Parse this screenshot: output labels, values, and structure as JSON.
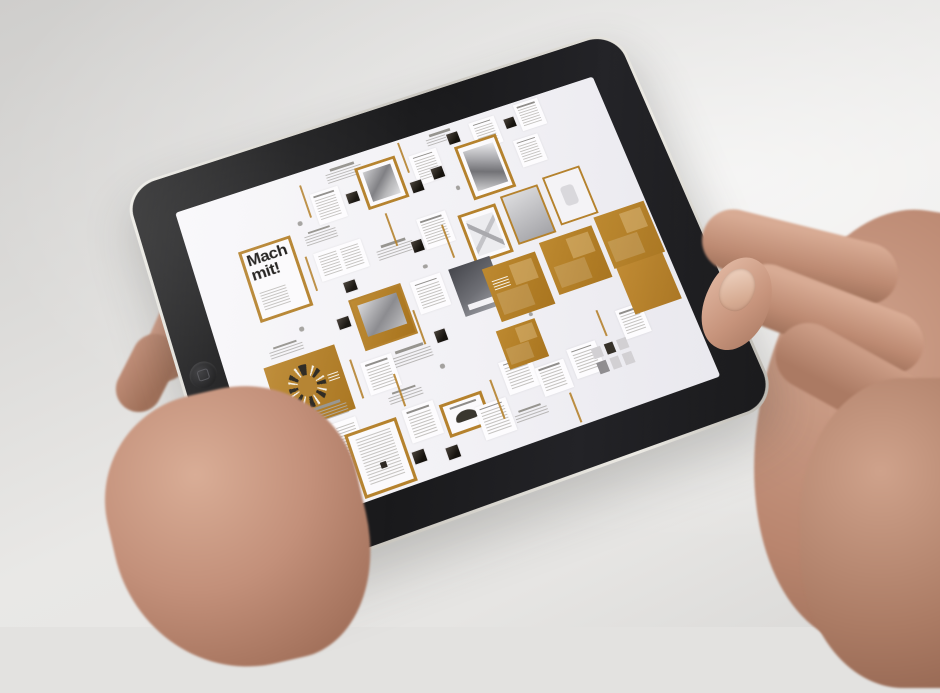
{
  "scene": {
    "subject": "two hands holding a black tablet in landscape orientation",
    "colors": {
      "wall": "#e3e2e0",
      "bezel": "#161618",
      "aluminum_rim": "#d8d5cd",
      "screen": "#f3f2f5",
      "accent_ochre": "#b5822d",
      "skin": "#c59a86"
    }
  },
  "tablet": {
    "orientation": "landscape",
    "home_button_side": "left",
    "screen": {
      "machmit_label": "Mach mit!",
      "content_kind": "editorial design flatplan collage with ochre accent pages",
      "items": [
        {
          "t": "cap",
          "x": 34,
          "y": 2,
          "w": 9,
          "h": 4.5
        },
        {
          "t": "vl",
          "x": 28,
          "y": 4,
          "w": 0.45,
          "h": 11
        },
        {
          "t": "pg",
          "x": 29.5,
          "y": 8,
          "w": 6.5,
          "h": 10
        },
        {
          "t": "chip",
          "x": 37,
          "y": 11,
          "w": 3,
          "h": 4
        },
        {
          "t": "fr-photo",
          "x": 41,
          "y": 4.5,
          "w": 9.5,
          "h": 14
        },
        {
          "t": "vl",
          "x": 52,
          "y": 1,
          "w": 0.45,
          "h": 10
        },
        {
          "t": "pg",
          "x": 53.5,
          "y": 6,
          "w": 6.5,
          "h": 10
        },
        {
          "t": "chip",
          "x": 51.5,
          "y": 14,
          "w": 3,
          "h": 4
        },
        {
          "t": "cap",
          "x": 58,
          "y": 1.5,
          "w": 8,
          "h": 4
        },
        {
          "t": "chip",
          "x": 63,
          "y": 3,
          "w": 3,
          "h": 4
        },
        {
          "t": "pg",
          "x": 69,
          "y": 2,
          "w": 6,
          "h": 9
        },
        {
          "t": "chip",
          "x": 76.5,
          "y": 4,
          "w": 3,
          "h": 4
        },
        {
          "t": "pg",
          "x": 80,
          "y": 1,
          "w": 6,
          "h": 9
        },
        {
          "t": "fr-machmit",
          "x": 10.5,
          "y": 18,
          "w": 12,
          "h": 23
        },
        {
          "t": "cap",
          "x": 25,
          "y": 19,
          "w": 8,
          "h": 4
        },
        {
          "t": "vl",
          "x": 24,
          "y": 26,
          "w": 0.45,
          "h": 11
        },
        {
          "t": "pg2",
          "x": 26,
          "y": 26,
          "w": 11,
          "h": 9
        },
        {
          "t": "chip",
          "x": 30,
          "y": 37,
          "w": 3,
          "h": 4
        },
        {
          "t": "cap",
          "x": 39,
          "y": 30,
          "w": 9,
          "h": 5
        },
        {
          "t": "vl",
          "x": 44,
          "y": 21,
          "w": 0.45,
          "h": 11
        },
        {
          "t": "chip",
          "x": 47,
          "y": 32,
          "w": 3,
          "h": 4
        },
        {
          "t": "pg",
          "x": 50,
          "y": 26,
          "w": 7,
          "h": 10
        },
        {
          "t": "vl",
          "x": 55,
          "y": 30,
          "w": 0.45,
          "h": 11
        },
        {
          "t": "fr-tall",
          "x": 64,
          "y": 8,
          "w": 10,
          "h": 18
        },
        {
          "t": "chip",
          "x": 57,
          "y": 12,
          "w": 3,
          "h": 4
        },
        {
          "t": "pg",
          "x": 77,
          "y": 12,
          "w": 6,
          "h": 9
        },
        {
          "t": "fr-x",
          "x": 59,
          "y": 29,
          "w": 9,
          "h": 16
        },
        {
          "t": "grey",
          "x": 69.5,
          "y": 27.5,
          "w": 9,
          "h": 16
        },
        {
          "t": "white-r",
          "x": 80,
          "y": 26,
          "w": 9,
          "h": 16
        },
        {
          "t": "chip",
          "x": 26,
          "y": 47,
          "w": 3,
          "h": 4
        },
        {
          "t": "ochrephoto",
          "x": 30,
          "y": 43,
          "w": 12,
          "h": 16
        },
        {
          "t": "pg",
          "x": 44,
          "y": 44,
          "w": 7,
          "h": 10
        },
        {
          "t": "vl",
          "x": 42.5,
          "y": 52,
          "w": 0.45,
          "h": 11
        },
        {
          "t": "cap",
          "x": 34,
          "y": 62,
          "w": 10,
          "h": 5
        },
        {
          "t": "chip",
          "x": 45,
          "y": 60,
          "w": 3,
          "h": 4
        },
        {
          "t": "dark",
          "x": 53,
          "y": 44,
          "w": 9.5,
          "h": 15
        },
        {
          "t": "ochre-lbl",
          "x": 60,
          "y": 47,
          "w": 12.5,
          "h": 17
        },
        {
          "t": "ochre-b",
          "x": 74,
          "y": 45,
          "w": 12.5,
          "h": 17
        },
        {
          "t": "ochre-b",
          "x": 87.5,
          "y": 43,
          "w": 12,
          "h": 17
        },
        {
          "t": "cap",
          "x": 10,
          "y": 49,
          "w": 8,
          "h": 4
        },
        {
          "t": "table",
          "x": 8,
          "y": 54,
          "w": 16,
          "h": 20
        },
        {
          "t": "vl",
          "x": 26,
          "y": 60,
          "w": 0.45,
          "h": 12
        },
        {
          "t": "pg",
          "x": 28,
          "y": 62,
          "w": 7,
          "h": 10
        },
        {
          "t": "ochre",
          "x": 1.5,
          "y": 74,
          "w": 10.5,
          "h": 24
        },
        {
          "t": "cap",
          "x": 14,
          "y": 70,
          "w": 9,
          "h": 4.5
        },
        {
          "t": "pg2",
          "x": 13.5,
          "y": 76,
          "w": 10,
          "h": 12
        },
        {
          "t": "vl",
          "x": 12.5,
          "y": 90,
          "w": 0.45,
          "h": 9
        },
        {
          "t": "fr-form",
          "x": 20,
          "y": 80,
          "w": 11.5,
          "h": 19
        },
        {
          "t": "cap",
          "x": 31,
          "y": 73,
          "w": 8,
          "h": 4
        },
        {
          "t": "vl",
          "x": 34,
          "y": 68,
          "w": 0.45,
          "h": 10
        },
        {
          "t": "pg",
          "x": 33,
          "y": 79,
          "w": 7,
          "h": 10
        },
        {
          "t": "chip",
          "x": 32,
          "y": 91,
          "w": 3,
          "h": 4
        },
        {
          "t": "fr-car",
          "x": 41,
          "y": 81,
          "w": 9.5,
          "h": 10
        },
        {
          "t": "chip",
          "x": 39,
          "y": 93,
          "w": 3,
          "h": 4
        },
        {
          "t": "pg",
          "x": 48,
          "y": 85,
          "w": 7,
          "h": 10
        },
        {
          "t": "vl",
          "x": 53,
          "y": 79,
          "w": 0.45,
          "h": 12
        },
        {
          "t": "pg",
          "x": 56,
          "y": 75,
          "w": 7,
          "h": 10
        },
        {
          "t": "cap",
          "x": 55,
          "y": 90,
          "w": 8,
          "h": 4
        },
        {
          "t": "ochre-b",
          "x": 58,
          "y": 66,
          "w": 9,
          "h": 12
        },
        {
          "t": "pg",
          "x": 63,
          "y": 80,
          "w": 6.5,
          "h": 9
        },
        {
          "t": "vl",
          "x": 68,
          "y": 90,
          "w": 0.45,
          "h": 9
        },
        {
          "t": "pg",
          "x": 71,
          "y": 78,
          "w": 6.5,
          "h": 9
        },
        {
          "t": "mini",
          "x": 76,
          "y": 80,
          "w": 8,
          "h": 8
        },
        {
          "t": "pg",
          "x": 84,
          "y": 72,
          "w": 6,
          "h": 9
        },
        {
          "t": "vl",
          "x": 80,
          "y": 70,
          "w": 0.45,
          "h": 8
        },
        {
          "t": "ochre",
          "x": 88,
          "y": 60,
          "w": 11,
          "h": 15
        },
        {
          "t": "dot",
          "x": 48,
          "y": 40,
          "w": 1,
          "h": 1.3
        },
        {
          "t": "dot",
          "x": 25,
          "y": 15,
          "w": 1,
          "h": 1.3
        },
        {
          "t": "dot",
          "x": 61,
          "y": 20,
          "w": 1,
          "h": 1.3
        },
        {
          "t": "dot",
          "x": 44,
          "y": 70,
          "w": 1,
          "h": 1.3
        },
        {
          "t": "dot",
          "x": 18,
          "y": 46,
          "w": 1,
          "h": 1.3
        },
        {
          "t": "dot",
          "x": 66,
          "y": 64,
          "w": 1,
          "h": 1.3
        }
      ]
    }
  }
}
